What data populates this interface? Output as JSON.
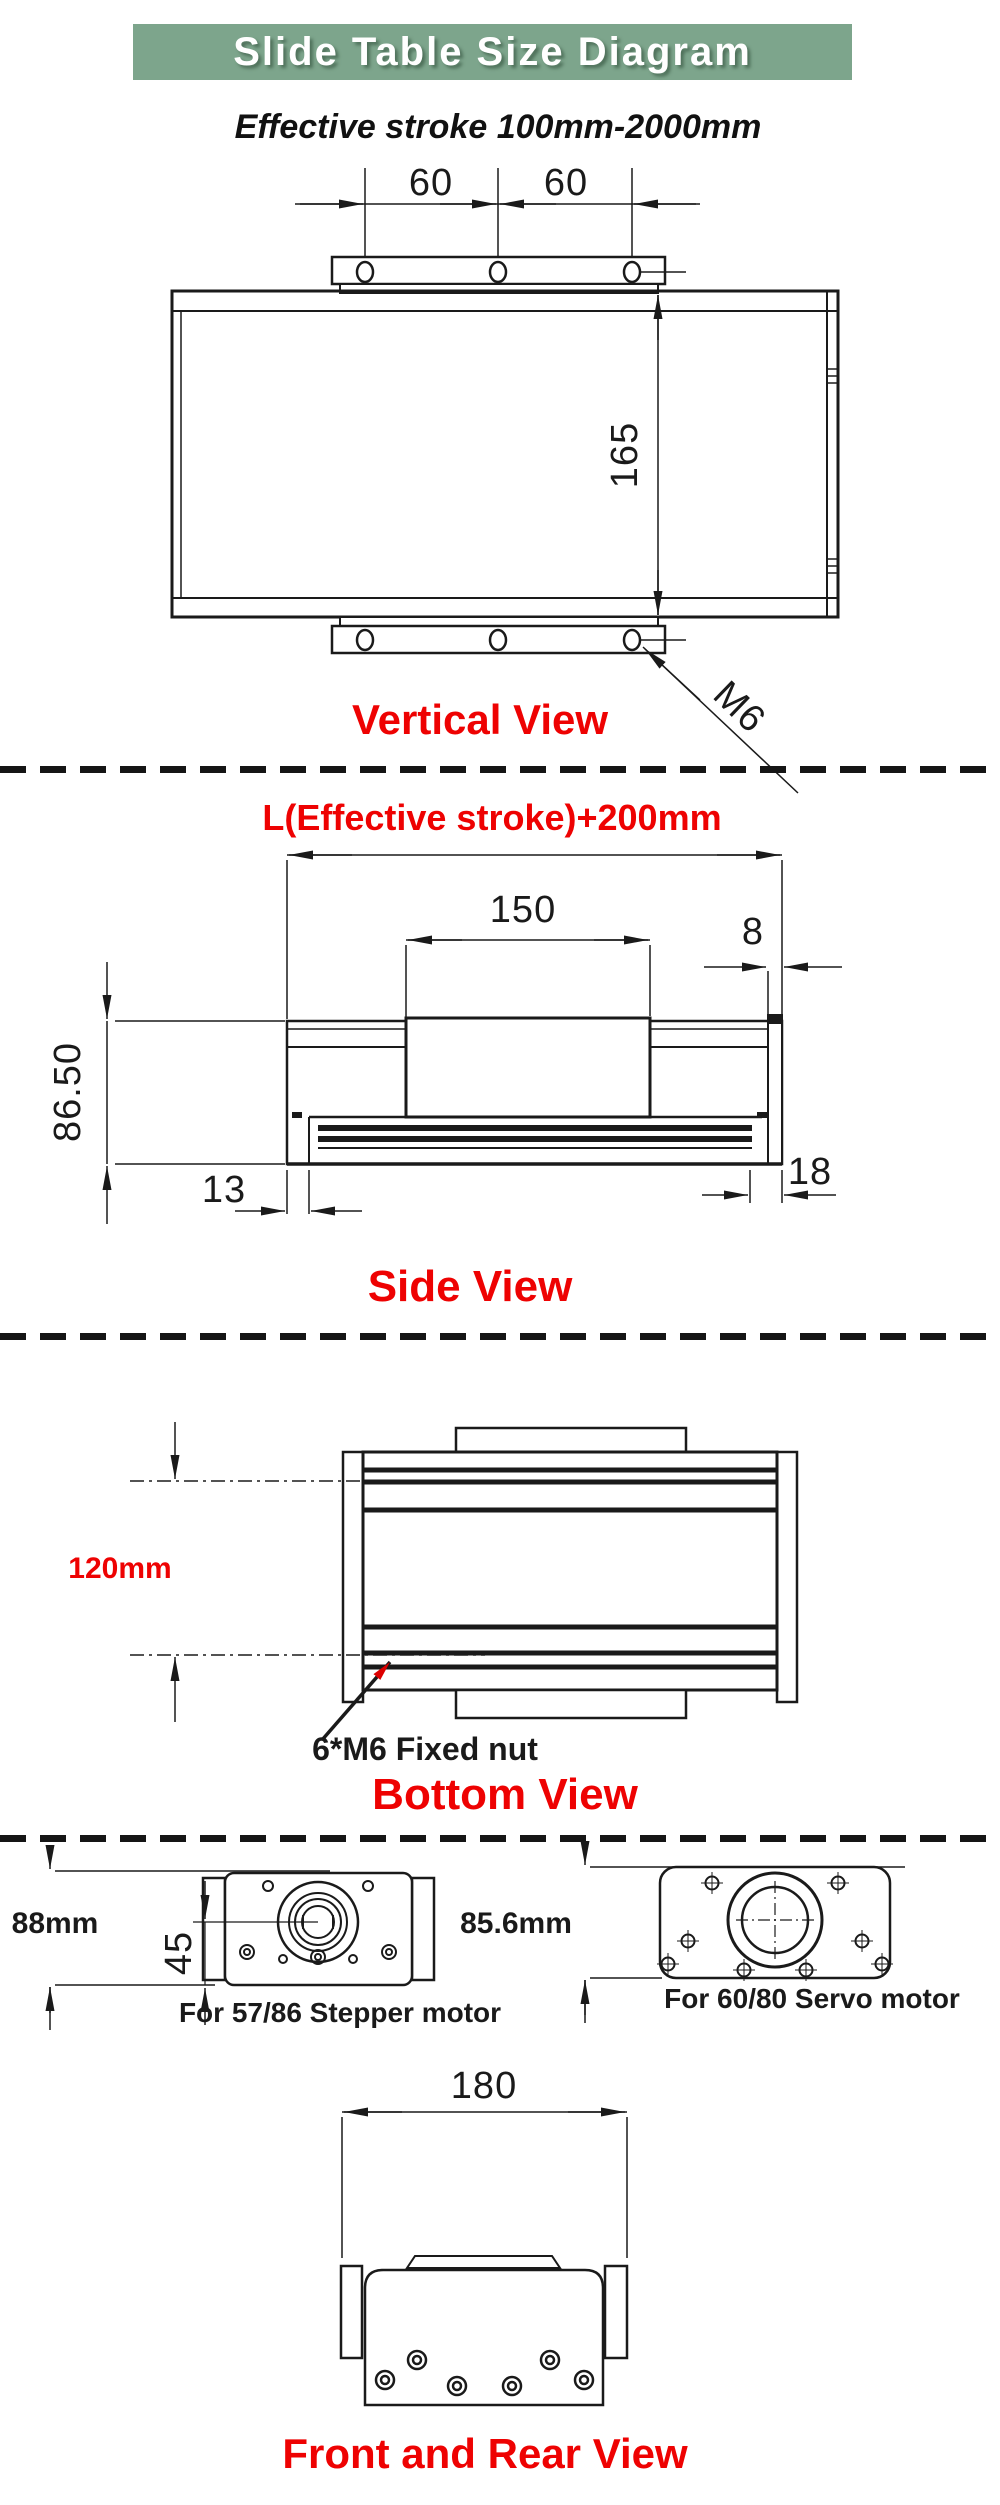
{
  "title": "Slide Table Size Diagram",
  "subtitle": "Effective stroke 100mm-2000mm",
  "colors": {
    "banner_green": "#7da58c",
    "label_red": "#ee0202",
    "line_black": "#1a1a1a",
    "arrow_red": "#dd0000"
  },
  "vertical": {
    "label": "Vertical View",
    "dim_left": "60",
    "dim_right": "60",
    "dim_height": "165",
    "thread_label": "M6"
  },
  "side": {
    "label": "Side View",
    "dim_length": "L(Effective stroke)+200mm",
    "dim_carriage": "150",
    "dim_endcap": "8",
    "dim_height": "86.50",
    "dim_left": "13",
    "dim_right": "18"
  },
  "bottom": {
    "label": "Bottom View",
    "dim_width": "120mm",
    "note": "6*M6 Fixed nut"
  },
  "motors": {
    "stepper_dim": "88mm",
    "stepper_shaft": "45",
    "stepper_caption": "For 57/86 Stepper motor",
    "servo_dim": "85.6mm",
    "servo_caption": "For 60/80 Servo motor"
  },
  "front_rear": {
    "label": "Front and Rear View",
    "dim_width": "180"
  }
}
